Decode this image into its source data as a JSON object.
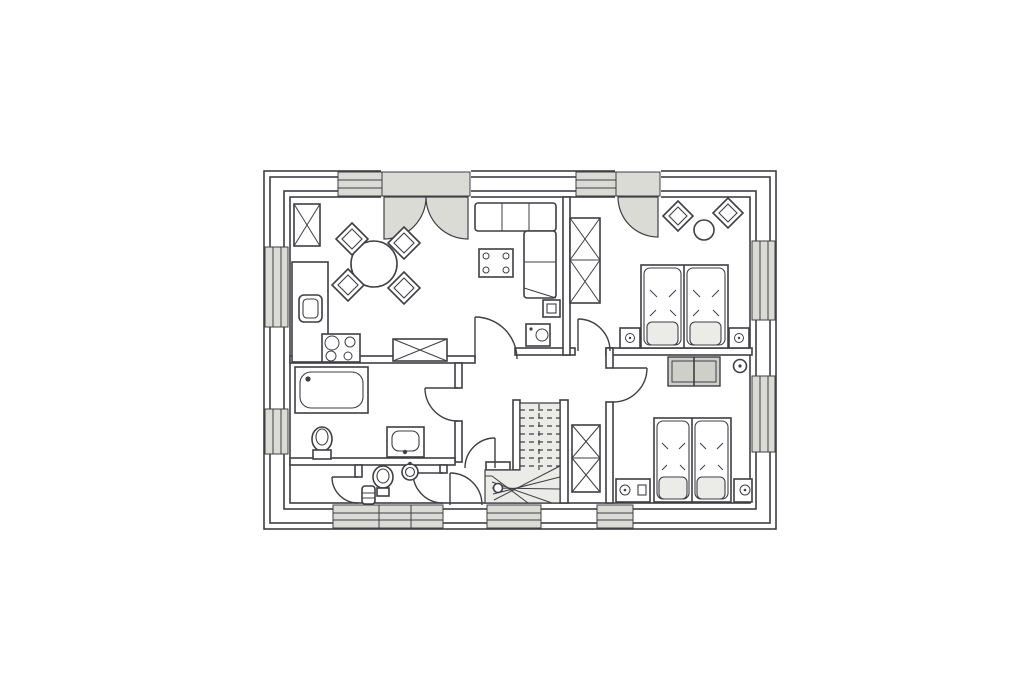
{
  "document": {
    "kind": "scanned architectural floor plan",
    "floor_hint": "upper floor (winder staircase present)",
    "visible_text": "none",
    "orientation": "rectangular footprint, wide landscape drawing centered on white paper"
  },
  "palette": {
    "paper": "#ffffff",
    "line": "#3f3f44",
    "line_soft": "#77777d",
    "shade_light": "#ebebe7",
    "shade_mid": "#dbdbd6",
    "shade_dark": "#cfcfca"
  },
  "structure": {
    "exterior_wall_parallel_lines": 4,
    "windows": [
      {
        "wall": "top",
        "count": 2,
        "note": "narrow sidelights next to the two balcony doors"
      },
      {
        "wall": "left",
        "count": 2,
        "note": "kitchen window, bathroom window"
      },
      {
        "wall": "right",
        "count": 2,
        "note": "one per bedroom"
      },
      {
        "wall": "bottom",
        "count": 4,
        "note": "storage, WC (double), hall, bedroom 2"
      }
    ],
    "exterior_doors": [
      {
        "wall": "top",
        "type": "double French/terrace door with two swing leaves",
        "room": "living room"
      },
      {
        "wall": "top",
        "type": "single balcony door",
        "room": "bedroom 1"
      }
    ],
    "interior_doors": 7,
    "staircase": {
      "type": "winder stair, quarter turn",
      "location": "bottom center",
      "details": "dashed treads in upper run, fanned solid winder treads at bottom, newel circle, handrail stub"
    }
  },
  "rooms": [
    {
      "id": "living",
      "name": "Living / dining room with open kitchen",
      "furniture": [
        "tall cabinet with X symbol",
        "kitchen counter with sink",
        "cooktop with 4 burners",
        "round dining table",
        "4 dining chairs (diamond symbols)",
        "sideboard with X symbol",
        "L-shaped corner sofa",
        "square coffee table with 4 dots",
        "TV square on wall",
        "media/stove unit with circle"
      ]
    },
    {
      "id": "bedroom1",
      "name": "Bedroom 1 (top right)",
      "furniture": [
        "double bed with 2 mattresses and 2 pillows",
        "2 nightstands with lamps",
        "double wardrobe with X symbols",
        "2 chairs (diamond symbols)",
        "small round table"
      ]
    },
    {
      "id": "bedroom2",
      "name": "Bedroom 2 (bottom right)",
      "furniture": [
        "double bed with 2 mattresses and 2 pillows",
        "2 nightstands with lamps",
        "gray dresser / chest of drawers",
        "round wall lamp"
      ]
    },
    {
      "id": "bathroom",
      "name": "Bathroom (left middle)",
      "furniture": [
        "bathtub",
        "toilet",
        "washbasin"
      ]
    },
    {
      "id": "wc",
      "name": "Separate WC (bottom left)",
      "furniture": [
        "toilet",
        "round washbasin",
        "small cabinet"
      ]
    },
    {
      "id": "storage",
      "name": "Small storage room (bottom left corner)",
      "furniture": []
    },
    {
      "id": "hall",
      "name": "Central hallway",
      "furniture": [
        "winder staircase",
        "double closet with X symbols"
      ]
    }
  ]
}
